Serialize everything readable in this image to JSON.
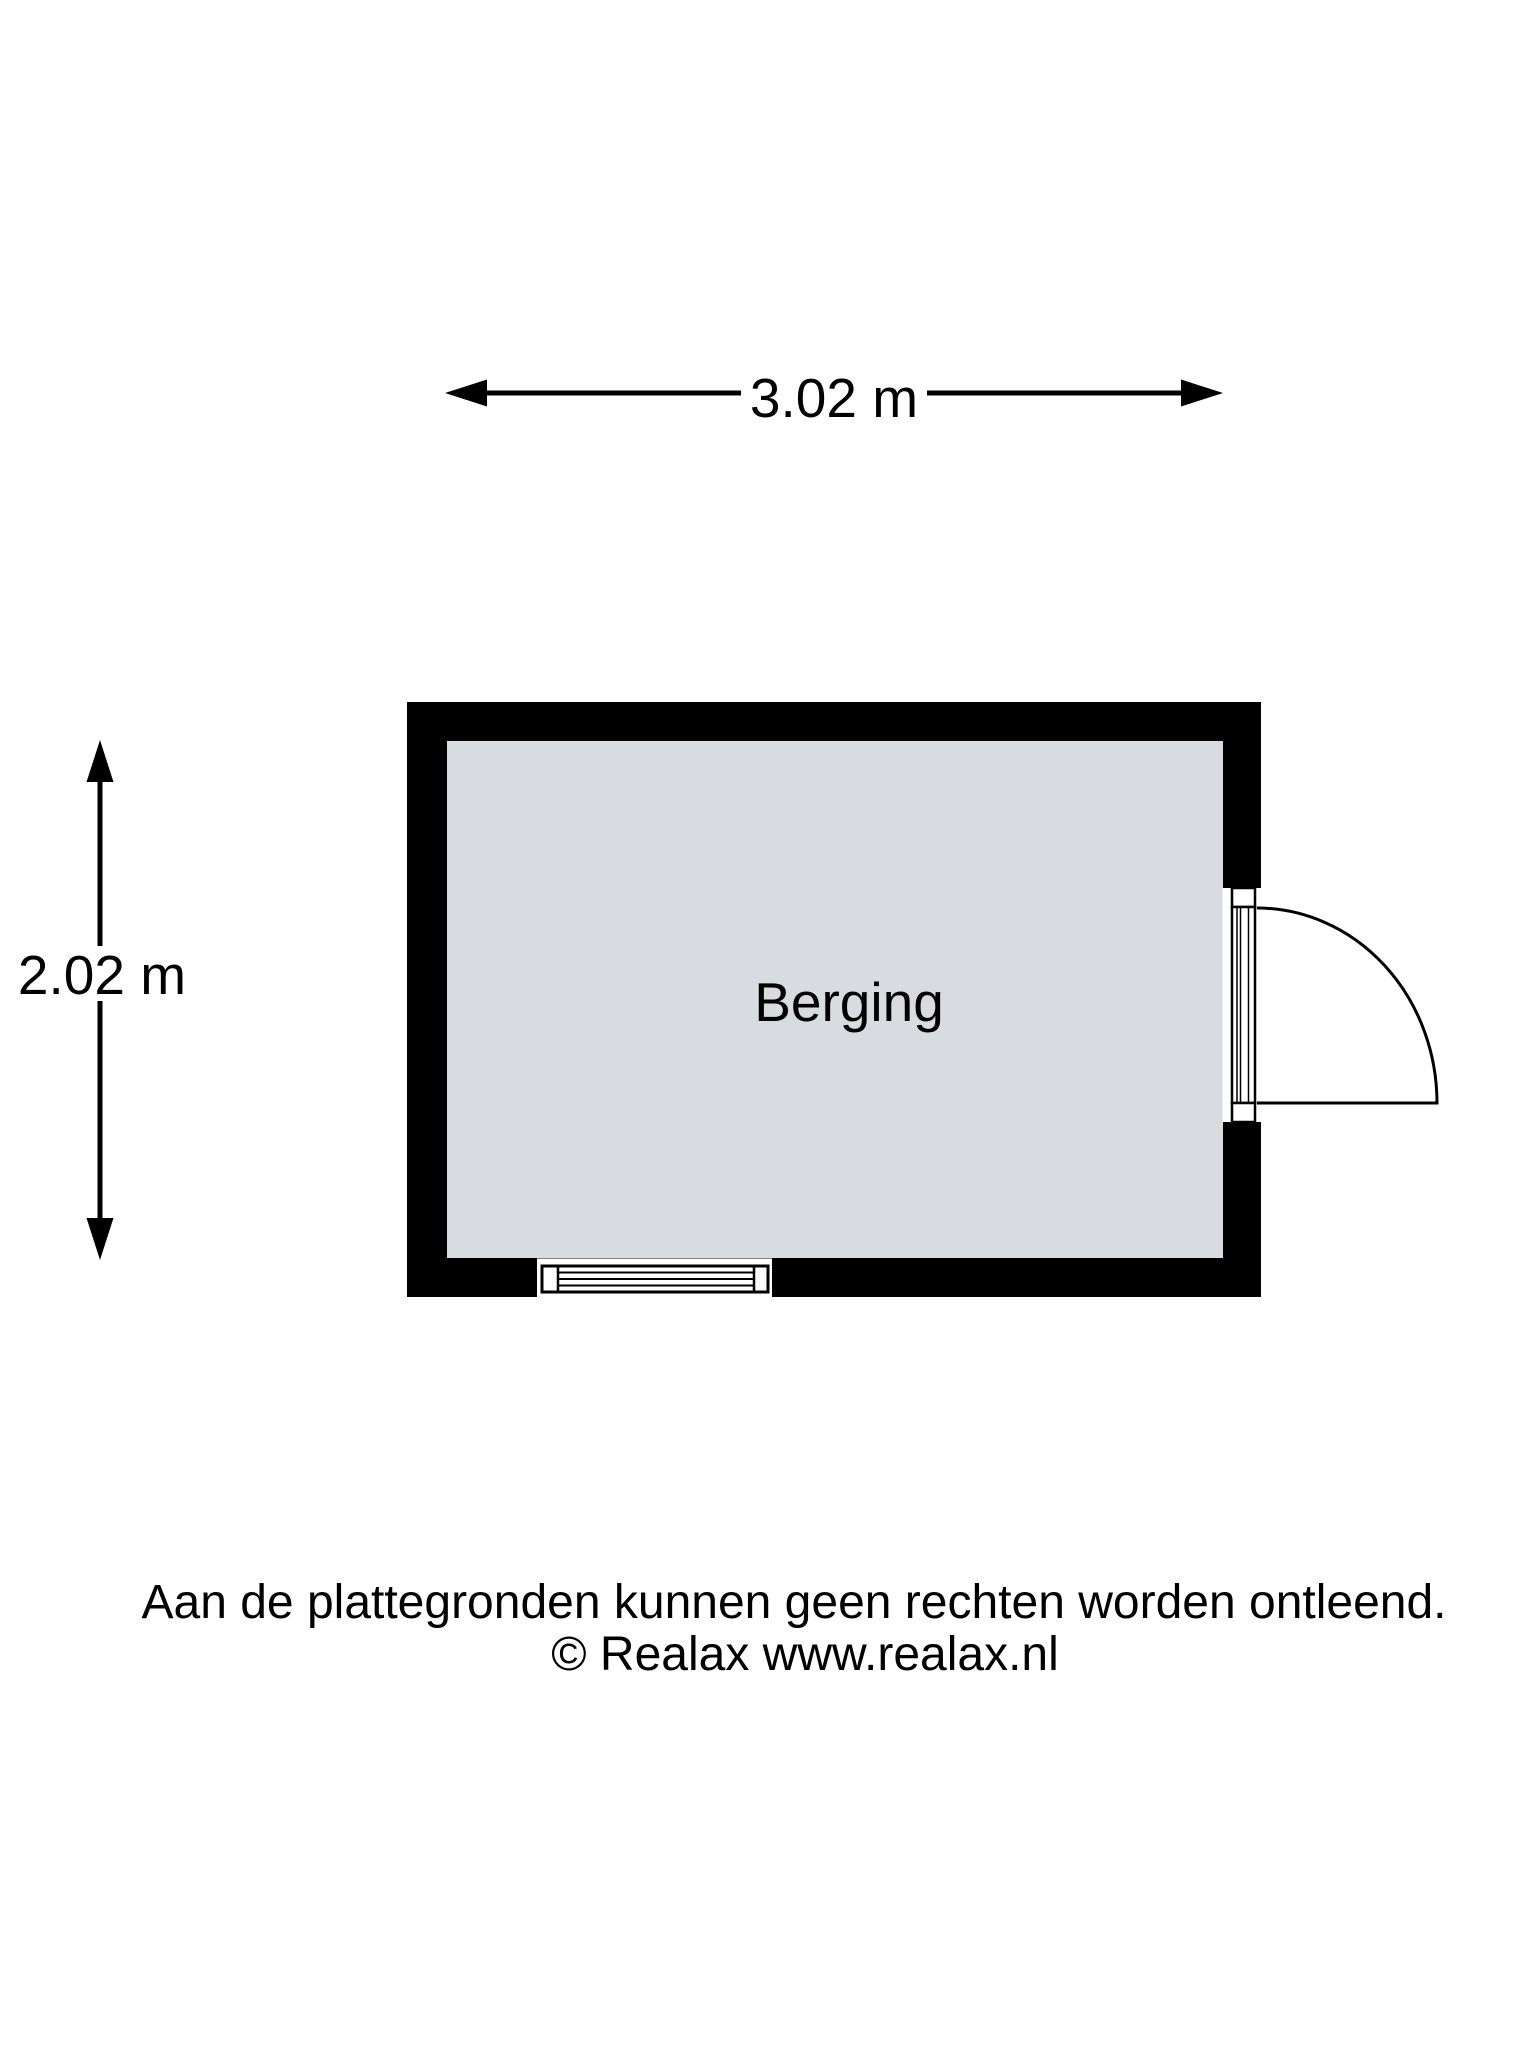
{
  "colors": {
    "background": "#ffffff",
    "wall": "#000000",
    "floor": "#d8dbdf",
    "line": "#000000",
    "text": "#000000"
  },
  "floor_plan": {
    "room": {
      "label": "Berging"
    },
    "dimensions": {
      "width": {
        "label": "3.02 m"
      },
      "height": {
        "label": "2.02 m"
      }
    }
  },
  "footer": {
    "disclaimer": "Aan de plattegronden kunnen geen rechten worden ontleend.",
    "copyright": "© Realax www.realax.nl"
  }
}
